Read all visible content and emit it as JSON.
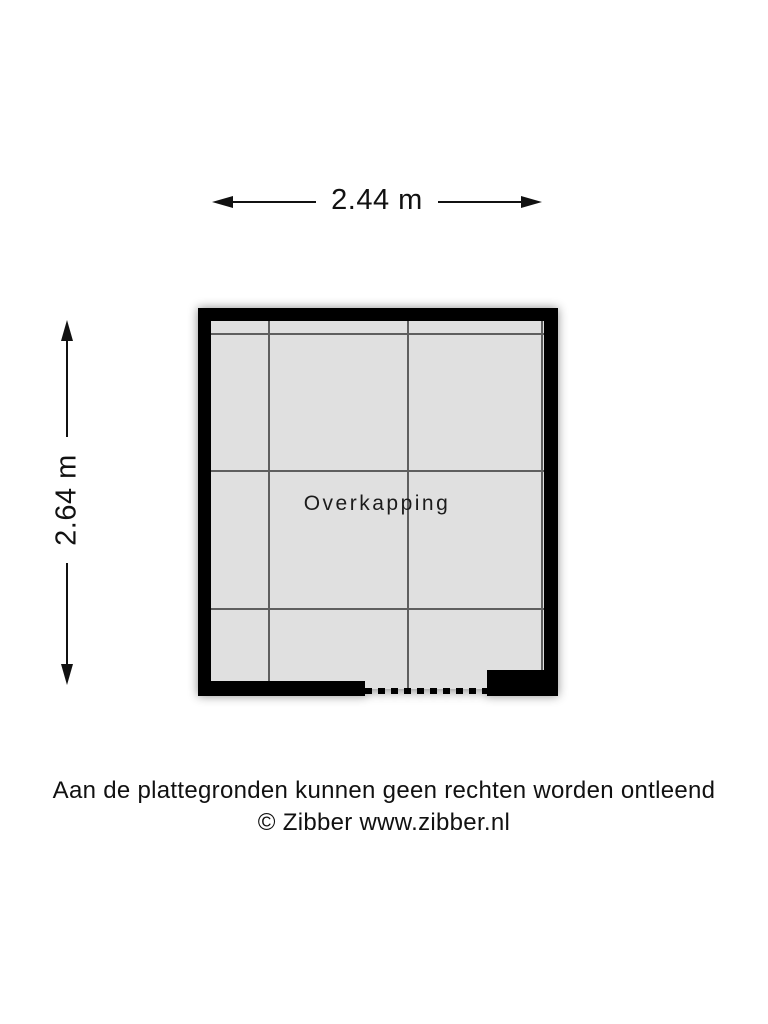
{
  "dimensions": {
    "width_label": "2.44 m",
    "height_label": "2.64 m"
  },
  "room": {
    "label": "Overkapping"
  },
  "footer": {
    "disclaimer": "Aan de plattegronden kunnen geen rechten worden ontleend",
    "copyright": "© Zibber www.zibber.nl"
  },
  "colors": {
    "wall": "#000000",
    "floor": "#e0e0e0",
    "gridline": "#5f5f5f",
    "dimension_line": "#111111",
    "background": "#ffffff",
    "text": "#111111"
  }
}
